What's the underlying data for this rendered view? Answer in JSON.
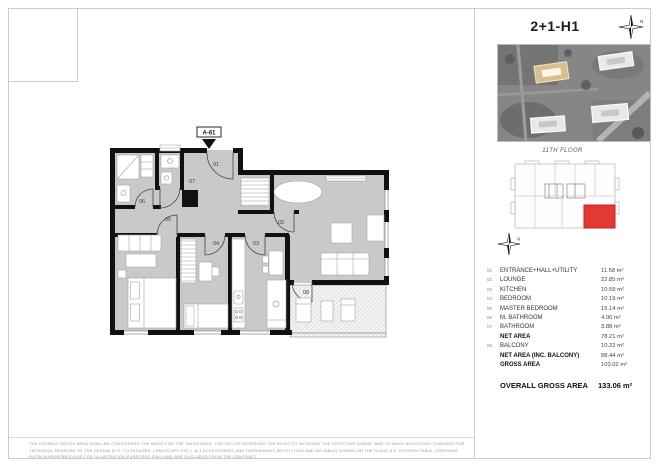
{
  "page": {
    "title": "2+1-H1",
    "floor_label": "11TH FLOOR",
    "disclaimer": "THE OVERALL GROSS AREA SHALL BE CONSIDERED THE BASIS FOR THE SALES AREA. THE SELLER RESERVED THE RIGHT TO INCREASE THE EFFECTIVE USAGE, AND TO MAKE NECESSARY CHANGES FOR TECHNICAL REASONS TO THE DESIGN (E.G. TO FAÇADES, LANDSCAPE ETC.). ALL ACCESSORIES AND FURNISHINGS (BOTH FIXED AND MOVABLE) SHOWN ON THE PLANS (I.E. KITCHEN TABLE, DRESSING ROOM WARDROBES) ARE FOR ILLUSTRATION PURPOSES ONLY AND ARE EXCLUDED FROM THE CONTRACT."
  },
  "plan": {
    "unit_marker": "A-61",
    "room_labels": {
      "r01": "01",
      "r02": "02",
      "r03": "03",
      "r04": "04",
      "r05": "05",
      "r06": "06",
      "r07": "07",
      "r08": "08"
    },
    "compass_letter": "N"
  },
  "areas": {
    "rows": [
      {
        "num": "01",
        "label": "ENTRANCE+HALL+UTILITY",
        "value": "11.58 m²",
        "bold": false
      },
      {
        "num": "02",
        "label": "LOUNGE",
        "value": "22.85 m²",
        "bold": false
      },
      {
        "num": "03",
        "label": "KITCHEN",
        "value": "10.59 m²",
        "bold": false
      },
      {
        "num": "04",
        "label": "BEDROOM",
        "value": "10.19 m²",
        "bold": false
      },
      {
        "num": "05",
        "label": "MASTER BEDROOM",
        "value": "15.14 m²",
        "bold": false
      },
      {
        "num": "06",
        "label": "M. BATHROOM",
        "value": "4.00 m²",
        "bold": false
      },
      {
        "num": "07",
        "label": "BATHROOM",
        "value": "3.88 m²",
        "bold": false
      },
      {
        "num": "",
        "label": "NET AREA",
        "value": "78.21 m²",
        "bold": true
      },
      {
        "num": "08",
        "label": "BALCONY",
        "value": "10.22 m²",
        "bold": false
      },
      {
        "num": "",
        "label": "NET AREA (INC. BALCONY)",
        "value": "88.44 m²",
        "bold": true
      },
      {
        "num": "",
        "label": "GROSS AREA",
        "value": "103.02 m²",
        "bold": true
      }
    ],
    "overall_label": "OVERALL GROSS AREA",
    "overall_value": "133.06 m²"
  },
  "colors": {
    "room_fill": "#c9c9c9",
    "wall": "#111111",
    "highlight_unit_red": "#e13a32",
    "highlight_building_tan": "#d9c08a"
  }
}
